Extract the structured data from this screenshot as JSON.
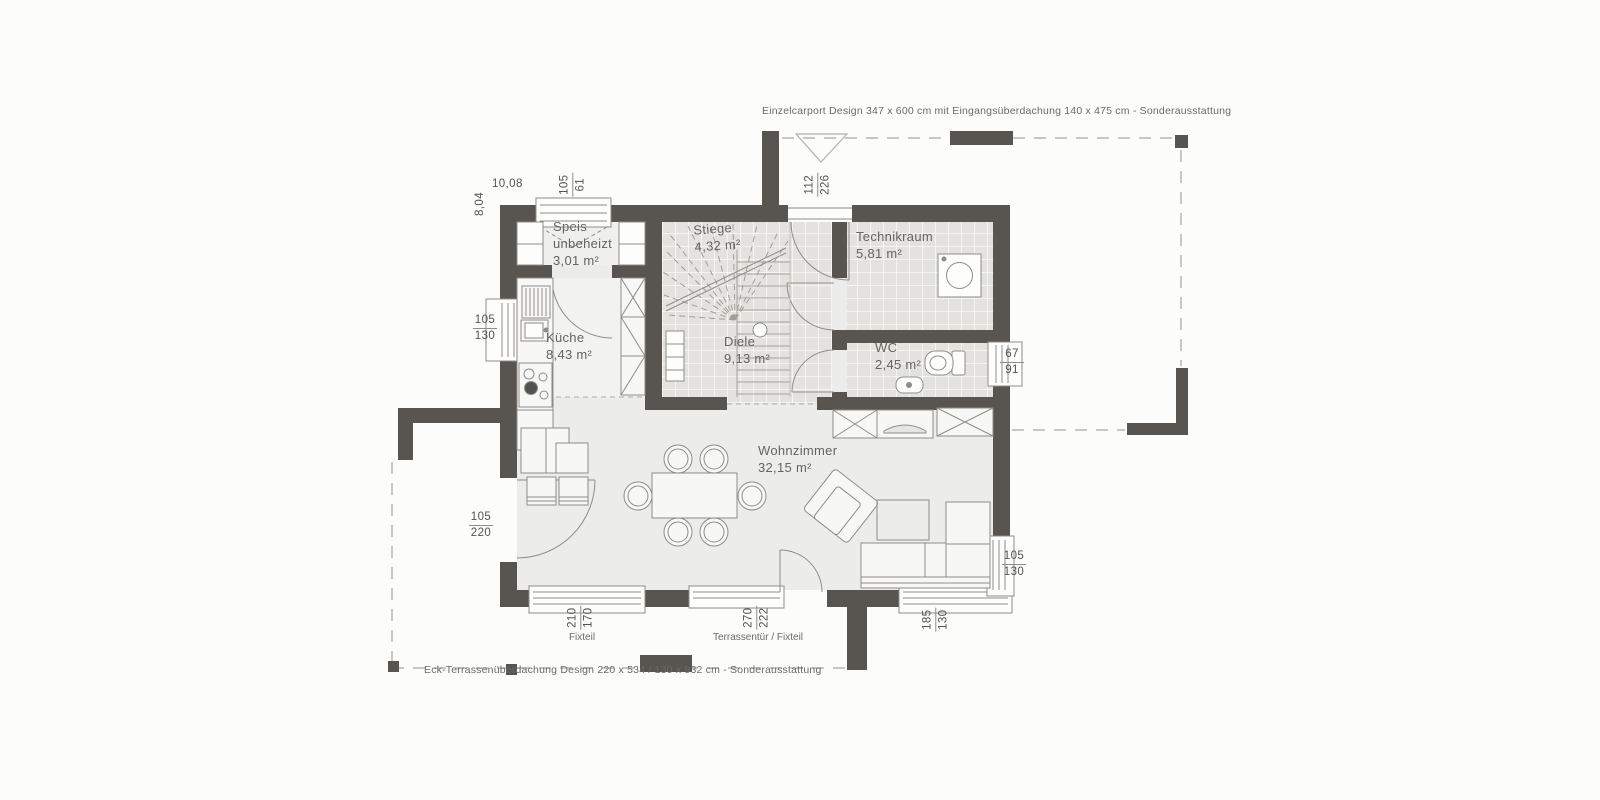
{
  "colors": {
    "wall": "#585550",
    "floor": "#ececeb",
    "tile_floor": "#e3e2de",
    "kitchen_floor": "#f2f2f0",
    "furniture_line": "#8f8d87",
    "dashed_line": "#b7b5b0",
    "label_text": "#66645f",
    "dim_text": "#55534e",
    "background": "#fcfcfb"
  },
  "notes": {
    "carport": "Einzelcarport Design 347 x 600 cm mit Eingangsüberdachung 140 x 475 cm - Sonderausstattung",
    "terrace": "Eck-Terrassenüberdachung Design 220 x 534 / 130 x 932 cm - Sonderausstattung"
  },
  "overall": {
    "width_m": "10,08",
    "height_m": "8,04"
  },
  "rooms": [
    {
      "name": "Speis",
      "sub": "unbeheizt",
      "area": "3,01 m²"
    },
    {
      "name": "Küche",
      "area": "8,43 m²"
    },
    {
      "name": "Stiege",
      "area": "4,32 m²"
    },
    {
      "name": "Diele",
      "area": "9,13 m²"
    },
    {
      "name": "Technikraum",
      "area": "5,81 m²"
    },
    {
      "name": "WC",
      "area": "2,45 m²"
    },
    {
      "name": "Wohnzimmer",
      "area": "32,15 m²"
    }
  ],
  "openings": {
    "speis_window": {
      "w": "105",
      "h": "61"
    },
    "entrance_door": {
      "w": "112",
      "h": "226"
    },
    "kitchen_window": {
      "w": "105",
      "h": "130"
    },
    "side_door": {
      "w": "105",
      "h": "220"
    },
    "wc_window": {
      "w": "67",
      "h": "91"
    },
    "fixteil": {
      "w": "210",
      "h": "170",
      "label": "Fixteil"
    },
    "terrassentuer": {
      "w": "270",
      "h": "222",
      "label": "Terrassentür / Fixteil"
    },
    "corner_window_bottom": {
      "w": "185",
      "h": "130"
    },
    "corner_window_right": {
      "w": "105",
      "h": "130"
    }
  }
}
